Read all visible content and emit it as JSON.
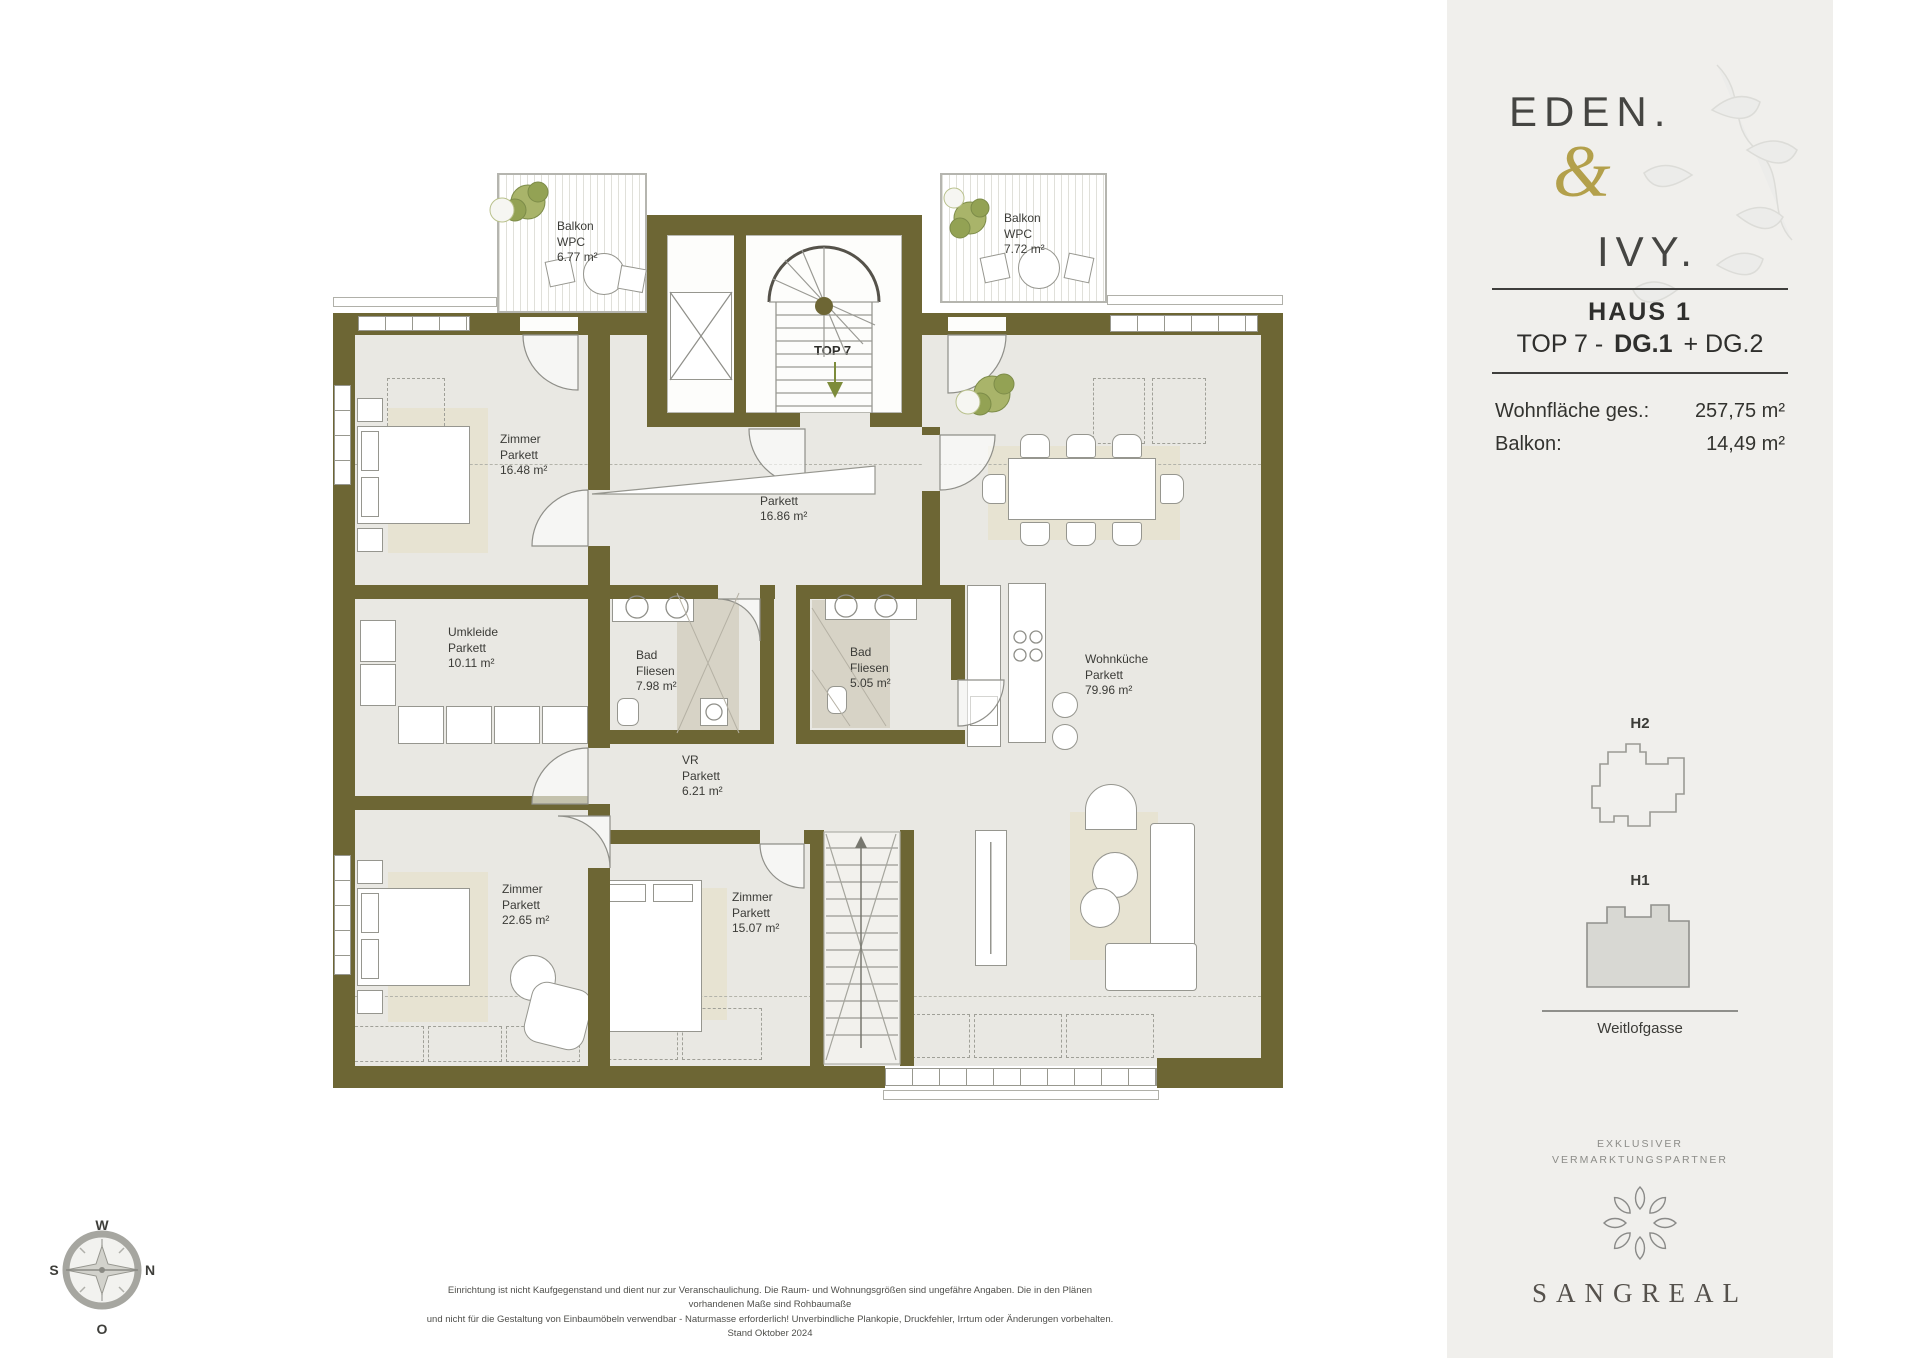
{
  "sidebar": {
    "logo": {
      "word1": "EDEN.",
      "amp": "&",
      "word2": "IVY."
    },
    "project": {
      "haus": "HAUS 1",
      "top_prefix": "TOP 7 -",
      "top_bold": "DG.1",
      "top_suffix": "+ DG.2"
    },
    "areas": [
      {
        "label": "Wohnfläche ges.:",
        "value": "257,75 m²"
      },
      {
        "label": "Balkon:",
        "value": "14,49 m²"
      }
    ],
    "buildings": {
      "h2_label": "H2",
      "h1_label": "H1",
      "street": "Weitlofgasse"
    },
    "partner": {
      "line1": "EXKLUSIVER",
      "line2": "VERMARKTUNGSPARTNER",
      "brand": "SANGREAL"
    }
  },
  "plan": {
    "unit_label": "TOP 7",
    "rooms": {
      "balkon1": {
        "name": "Balkon",
        "floor": "WPC",
        "area": "6.77 m²"
      },
      "balkon2": {
        "name": "Balkon",
        "floor": "WPC",
        "area": "7.72 m²"
      },
      "zimmer1": {
        "name": "Zimmer",
        "floor": "Parkett",
        "area": "16.48 m²"
      },
      "vr1": {
        "name": "VR",
        "floor": "Parkett",
        "area": "16.86 m²"
      },
      "umkleide": {
        "name": "Umkleide",
        "floor": "Parkett",
        "area": "10.11 m²"
      },
      "bad1": {
        "name": "Bad",
        "floor": "Fliesen",
        "area": "7.98 m²"
      },
      "bad2": {
        "name": "Bad",
        "floor": "Fliesen",
        "area": "5.05 m²"
      },
      "vr2": {
        "name": "VR",
        "floor": "Parkett",
        "area": "6.21 m²"
      },
      "wohnkueche": {
        "name": "Wohnküche",
        "floor": "Parkett",
        "area": "79.96 m²"
      },
      "zimmer2": {
        "name": "Zimmer",
        "floor": "Parkett",
        "area": "22.65 m²"
      },
      "zimmer3": {
        "name": "Zimmer",
        "floor": "Parkett",
        "area": "15.07 m²"
      }
    },
    "compass": {
      "n": "N",
      "s": "S",
      "w": "W",
      "o": "O"
    }
  },
  "footer": {
    "line1": "Einrichtung ist nicht Kaufgegenstand und dient nur zur Veranschaulichung. Die Raum- und Wohnungsgrößen sind ungefähre Angaben. Die in den Plänen vorhandenen Maße sind Rohbaumaße",
    "line2": "und nicht für die Gestaltung von Einbaumöbeln verwendbar - Naturmasse erforderlich! Unverbindliche Plankopie, Druckfehler, Irrtum oder Änderungen vorbehalten. Stand Oktober 2024"
  },
  "colors": {
    "wall": "#6d6634",
    "floor": "#e9e8e3",
    "accent_gold": "#b3a04b",
    "tile": "#d7d3c6",
    "rug": "#e7e3d2",
    "plant": "#9aa85c",
    "sidebar_bg": "#f0efec"
  }
}
